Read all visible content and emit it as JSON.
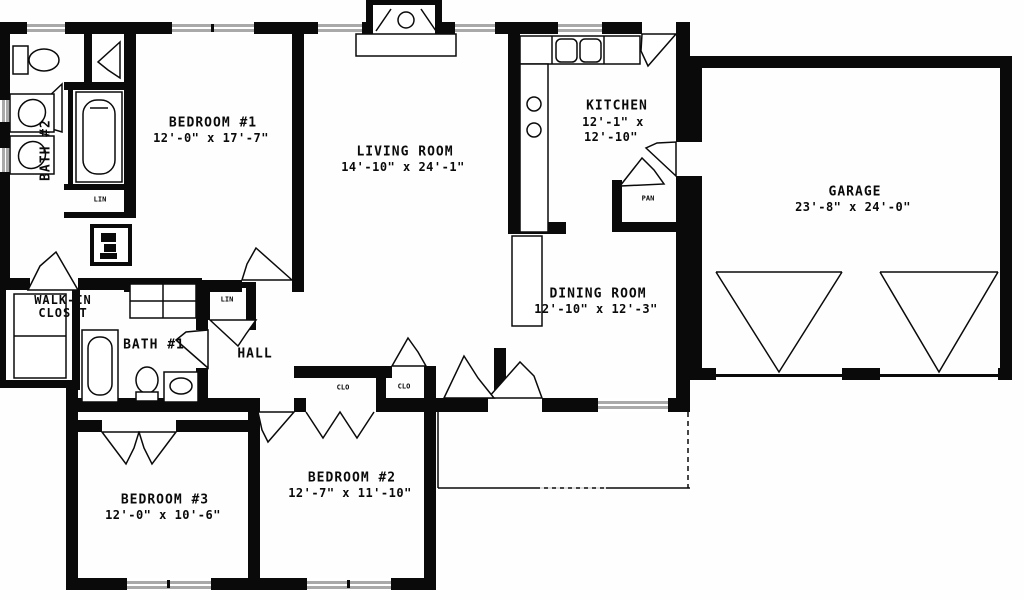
{
  "title": "Single-story house floor plan",
  "rooms": {
    "bedroom1": {
      "name": "BEDROOM #1",
      "dims": "12'-0\" x 17'-7\""
    },
    "living": {
      "name": "LIVING ROOM",
      "dims": "14'-10\" x 24'-1\""
    },
    "kitchen": {
      "name": "KITCHEN",
      "dims1": "12'-1\" x",
      "dims2": "12'-10\""
    },
    "garage": {
      "name": "GARAGE",
      "dims": "23'-8\" x 24'-0\""
    },
    "dining": {
      "name": "DINING ROOM",
      "dims": "12'-10\" x 12'-3\""
    },
    "walkin": {
      "line1": "WALK-IN",
      "line2": "CLOSET"
    },
    "bath1": {
      "name": "BATH #1"
    },
    "bath2": {
      "name": "BATH #2"
    },
    "hall": {
      "name": "HALL"
    },
    "bedroom3": {
      "name": "BEDROOM #3",
      "dims": "12'-0\" x 10'-6\""
    },
    "bedroom2": {
      "name": "BEDROOM #2",
      "dims": "12'-7\" x 11'-10\""
    }
  },
  "closets": {
    "linen_bath": "LIN",
    "linen_hall": "LIN",
    "pantry": "PAN",
    "closet_left": "CLO",
    "closet_right": "CLO"
  },
  "colors": {
    "wall": "#0a0a0a",
    "window": "#a9a9a9",
    "background": "#fefefe"
  }
}
